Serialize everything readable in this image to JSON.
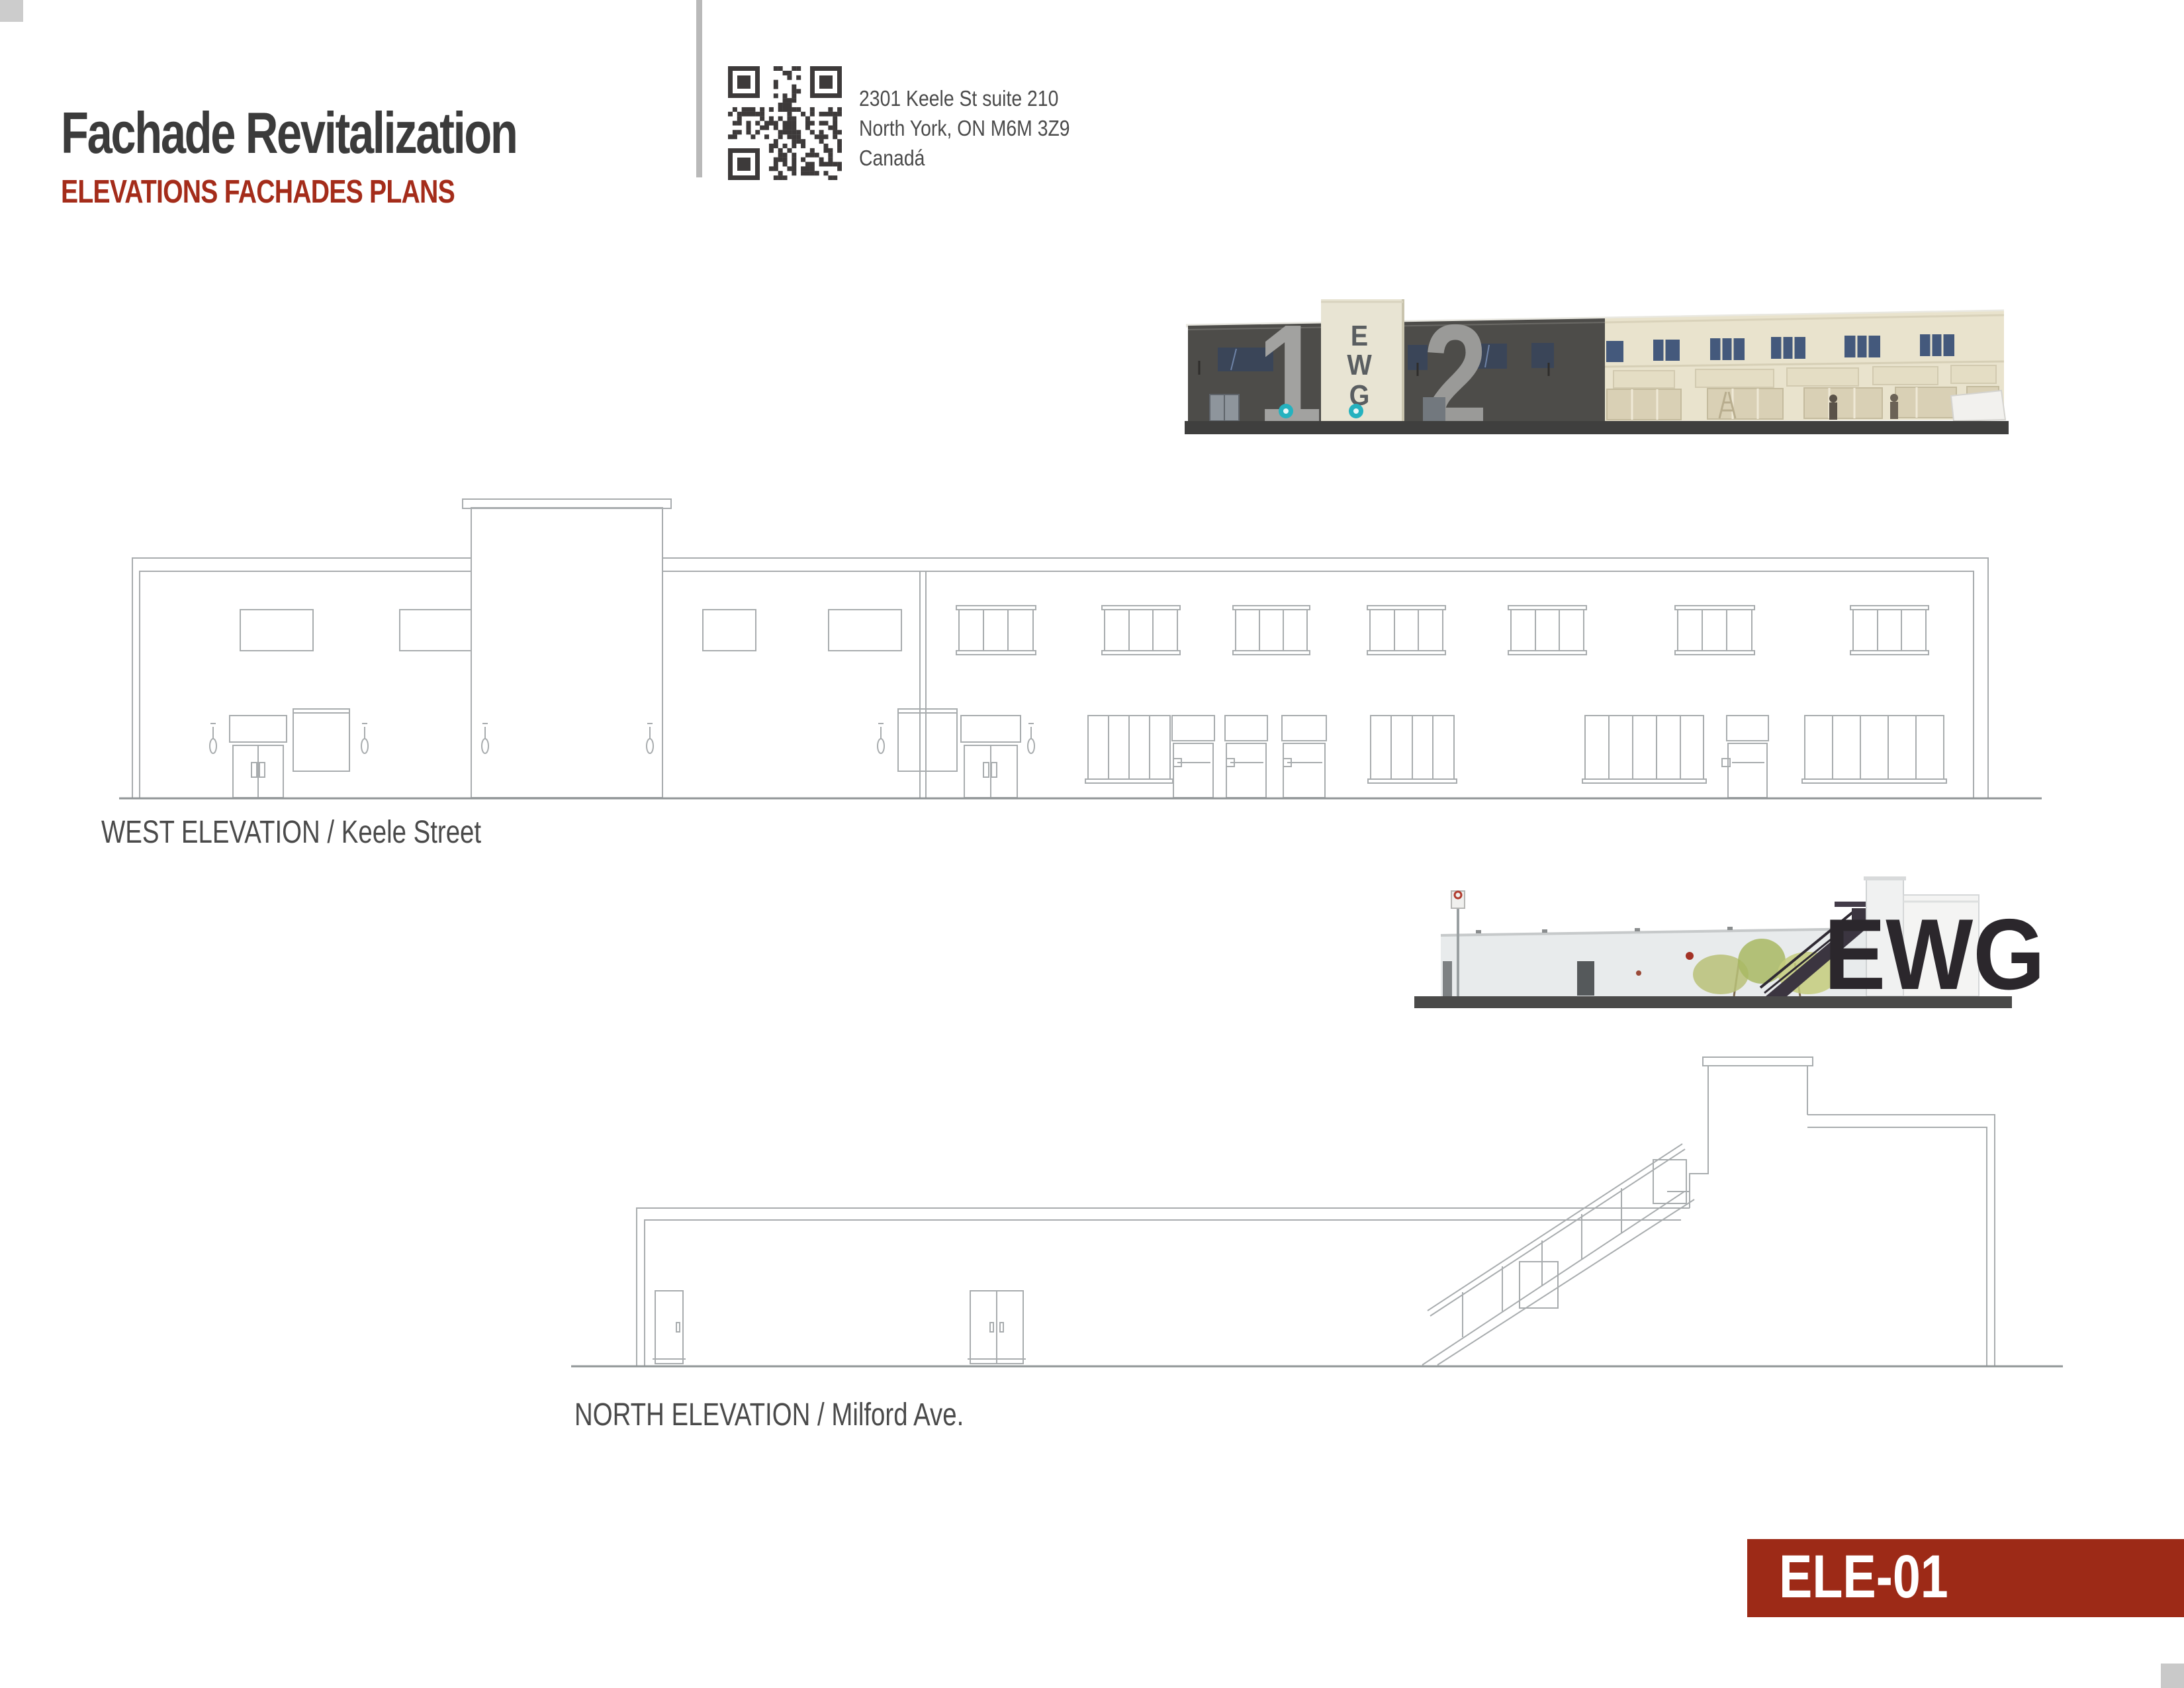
{
  "header": {
    "title": "Fachade Revitalization",
    "subtitle": "ELEVATIONS FACHADES PLANS",
    "address_lines": [
      "2301 Keele St suite 210",
      "North York, ON M6M 3Z9",
      "Canadá"
    ]
  },
  "elevations": {
    "west_label": "WEST ELEVATION / Keele Street",
    "north_label": "NORTH ELEVATION / Milford Ave."
  },
  "photos": {
    "strip1": {
      "tower_letter_e": "E",
      "tower_letter_w": "W",
      "tower_letter_g": "G",
      "unit_number_left": "1",
      "unit_number_right": "2"
    },
    "strip2": {
      "sign_text": "EWG"
    }
  },
  "badge": {
    "code": "ELE-01"
  },
  "colors": {
    "accent_red": "#9d2a17",
    "subtitle_red": "#a42c1a",
    "title_gray": "#3b3b3b",
    "label_gray": "#4a4a4a",
    "drawing_line_gray": "#a8acae",
    "photo_dark_facade": "#4d4c49",
    "photo_cream_facade": "#e9e3cd",
    "photo_ground": "#3f3f3e",
    "corner_gray": "#cccccc"
  }
}
